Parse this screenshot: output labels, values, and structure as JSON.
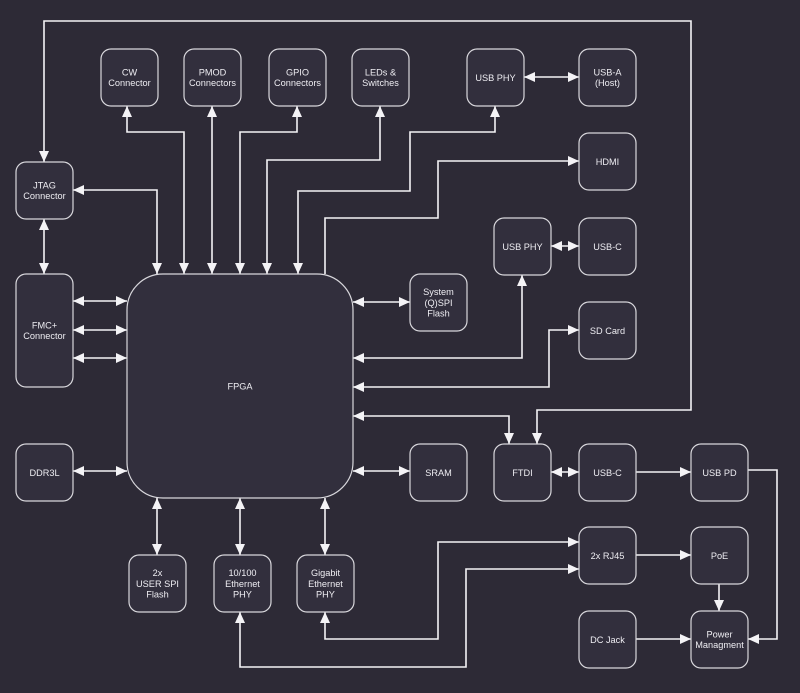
{
  "canvas": {
    "width": 800,
    "height": 693
  },
  "colors": {
    "background": "#2d2a36",
    "node_fill": "#322f3d",
    "node_border": "#d8d7dc",
    "edge": "#f4f3f6",
    "text": "#eeedf2"
  },
  "diagram": {
    "nodes": [
      {
        "id": "cw-connector",
        "label": [
          "CW",
          "Connector"
        ],
        "x": 101,
        "y": 49,
        "w": 57,
        "h": 57,
        "rx": 10
      },
      {
        "id": "pmod-connectors",
        "label": [
          "PMOD",
          "Connectors"
        ],
        "x": 184,
        "y": 49,
        "w": 57,
        "h": 57,
        "rx": 10
      },
      {
        "id": "gpio-connectors",
        "label": [
          "GPIO",
          "Connectors"
        ],
        "x": 269,
        "y": 49,
        "w": 57,
        "h": 57,
        "rx": 10
      },
      {
        "id": "leds-switches",
        "label": [
          "LEDs &",
          "Switches"
        ],
        "x": 352,
        "y": 49,
        "w": 57,
        "h": 57,
        "rx": 10
      },
      {
        "id": "usb-phy-top",
        "label": [
          "USB PHY"
        ],
        "x": 467,
        "y": 49,
        "w": 57,
        "h": 57,
        "rx": 10
      },
      {
        "id": "usb-a-host",
        "label": [
          "USB-A",
          "(Host)"
        ],
        "x": 579,
        "y": 49,
        "w": 57,
        "h": 57,
        "rx": 10
      },
      {
        "id": "jtag-connector",
        "label": [
          "JTAG",
          "Connector"
        ],
        "x": 16,
        "y": 162,
        "w": 57,
        "h": 57,
        "rx": 10
      },
      {
        "id": "hdmi",
        "label": [
          "HDMI"
        ],
        "x": 579,
        "y": 133,
        "w": 57,
        "h": 57,
        "rx": 10
      },
      {
        "id": "usb-phy-mid",
        "label": [
          "USB PHY"
        ],
        "x": 494,
        "y": 218,
        "w": 57,
        "h": 57,
        "rx": 10
      },
      {
        "id": "usb-c-top",
        "label": [
          "USB-C"
        ],
        "x": 579,
        "y": 218,
        "w": 57,
        "h": 57,
        "rx": 10
      },
      {
        "id": "fmc-connector",
        "label": [
          "FMC+",
          "Connector"
        ],
        "x": 16,
        "y": 274,
        "w": 57,
        "h": 113,
        "rx": 10
      },
      {
        "id": "system-qspi-flash",
        "label": [
          "System",
          "(Q)SPI",
          "Flash"
        ],
        "x": 410,
        "y": 274,
        "w": 57,
        "h": 57,
        "rx": 10
      },
      {
        "id": "sd-card",
        "label": [
          "SD Card"
        ],
        "x": 579,
        "y": 302,
        "w": 57,
        "h": 57,
        "rx": 10
      },
      {
        "id": "fpga",
        "label": [
          "FPGA"
        ],
        "x": 127,
        "y": 274,
        "w": 226,
        "h": 224,
        "rx": 36
      },
      {
        "id": "ddr3l",
        "label": [
          "DDR3L"
        ],
        "x": 16,
        "y": 444,
        "w": 57,
        "h": 57,
        "rx": 10
      },
      {
        "id": "sram",
        "label": [
          "SRAM"
        ],
        "x": 410,
        "y": 444,
        "w": 57,
        "h": 57,
        "rx": 10
      },
      {
        "id": "ftdi",
        "label": [
          "FTDI"
        ],
        "x": 494,
        "y": 444,
        "w": 57,
        "h": 57,
        "rx": 10
      },
      {
        "id": "usb-c-bottom",
        "label": [
          "USB-C"
        ],
        "x": 579,
        "y": 444,
        "w": 57,
        "h": 57,
        "rx": 10
      },
      {
        "id": "usb-pd",
        "label": [
          "USB PD"
        ],
        "x": 691,
        "y": 444,
        "w": 57,
        "h": 57,
        "rx": 10
      },
      {
        "id": "user-spi-flash",
        "label": [
          "2x",
          "USER SPI",
          "Flash"
        ],
        "x": 129,
        "y": 555,
        "w": 57,
        "h": 57,
        "rx": 10
      },
      {
        "id": "ethernet-phy-10-100",
        "label": [
          "10/100",
          "Ethernet",
          "PHY"
        ],
        "x": 214,
        "y": 555,
        "w": 57,
        "h": 57,
        "rx": 10
      },
      {
        "id": "ethernet-phy-gigabit",
        "label": [
          "Gigabit",
          "Ethernet",
          "PHY"
        ],
        "x": 297,
        "y": 555,
        "w": 57,
        "h": 57,
        "rx": 10
      },
      {
        "id": "rj45",
        "label": [
          "2x RJ45"
        ],
        "x": 579,
        "y": 527,
        "w": 57,
        "h": 57,
        "rx": 10
      },
      {
        "id": "poe",
        "label": [
          "PoE"
        ],
        "x": 691,
        "y": 527,
        "w": 57,
        "h": 57,
        "rx": 10
      },
      {
        "id": "dc-jack",
        "label": [
          "DC Jack"
        ],
        "x": 579,
        "y": 611,
        "w": 57,
        "h": 57,
        "rx": 10
      },
      {
        "id": "power-management",
        "label": [
          "Power",
          "Managment"
        ],
        "x": 691,
        "y": 611,
        "w": 57,
        "h": 57,
        "rx": 10
      }
    ],
    "edges": [
      {
        "from": "jtag-connector",
        "to": "ftdi",
        "arrows": "both",
        "points": [
          [
            44,
            162
          ],
          [
            44,
            21
          ],
          [
            691,
            21
          ],
          [
            691,
            410
          ],
          [
            537,
            410
          ],
          [
            537,
            444
          ]
        ]
      },
      {
        "from": "jtag-connector",
        "to": "fpga",
        "arrows": "both",
        "points": [
          [
            73,
            190
          ],
          [
            157,
            190
          ],
          [
            157,
            274
          ]
        ]
      },
      {
        "from": "cw-connector",
        "to": "fpga",
        "arrows": "both",
        "points": [
          [
            127,
            106
          ],
          [
            127,
            132
          ],
          [
            184,
            132
          ],
          [
            184,
            274
          ]
        ]
      },
      {
        "from": "pmod-connectors",
        "to": "fpga",
        "arrows": "both",
        "points": [
          [
            212,
            106
          ],
          [
            212,
            274
          ]
        ]
      },
      {
        "from": "gpio-connectors",
        "to": "fpga",
        "arrows": "both",
        "points": [
          [
            297,
            106
          ],
          [
            297,
            132
          ],
          [
            240,
            132
          ],
          [
            240,
            274
          ]
        ]
      },
      {
        "from": "leds-switches",
        "to": "fpga",
        "arrows": "both",
        "points": [
          [
            380,
            106
          ],
          [
            380,
            160
          ],
          [
            267,
            160
          ],
          [
            267,
            274
          ]
        ]
      },
      {
        "from": "usb-phy-top",
        "to": "fpga",
        "arrows": "both",
        "points": [
          [
            495,
            106
          ],
          [
            495,
            132
          ],
          [
            410,
            132
          ],
          [
            410,
            191
          ],
          [
            298,
            191
          ],
          [
            298,
            274
          ]
        ]
      },
      {
        "from": "usb-phy-top",
        "to": "usb-a-host",
        "arrows": "both",
        "points": [
          [
            524,
            77
          ],
          [
            579,
            77
          ]
        ]
      },
      {
        "from": "fpga",
        "to": "hdmi",
        "arrows": "end",
        "points": [
          [
            325,
            274
          ],
          [
            325,
            218
          ],
          [
            438,
            218
          ],
          [
            438,
            161
          ],
          [
            579,
            161
          ]
        ]
      },
      {
        "from": "usb-phy-mid",
        "to": "usb-c-top",
        "arrows": "both",
        "points": [
          [
            551,
            246
          ],
          [
            579,
            246
          ]
        ]
      },
      {
        "from": "fpga",
        "to": "system-qspi-flash",
        "arrows": "both",
        "points": [
          [
            353,
            302
          ],
          [
            410,
            302
          ]
        ]
      },
      {
        "from": "fpga",
        "to": "usb-phy-mid",
        "arrows": "both",
        "points": [
          [
            353,
            358
          ],
          [
            522,
            358
          ],
          [
            522,
            275
          ]
        ]
      },
      {
        "from": "fpga",
        "to": "sd-card",
        "arrows": "both",
        "points": [
          [
            353,
            387
          ],
          [
            549,
            387
          ],
          [
            549,
            330
          ],
          [
            579,
            330
          ]
        ]
      },
      {
        "from": "fpga",
        "to": "ftdi",
        "arrows": "both",
        "points": [
          [
            353,
            416
          ],
          [
            509,
            416
          ],
          [
            509,
            444
          ]
        ]
      },
      {
        "from": "jtag-connector",
        "to": "fmc-connector",
        "arrows": "both",
        "points": [
          [
            44,
            219
          ],
          [
            44,
            274
          ]
        ]
      },
      {
        "from": "fmc-connector",
        "to": "fpga",
        "arrows": "both",
        "points": [
          [
            73,
            301
          ],
          [
            127,
            301
          ]
        ]
      },
      {
        "from": "fmc-connector",
        "to": "fpga",
        "arrows": "both",
        "points": [
          [
            73,
            330
          ],
          [
            127,
            330
          ]
        ]
      },
      {
        "from": "fmc-connector",
        "to": "fpga",
        "arrows": "both",
        "points": [
          [
            73,
            358
          ],
          [
            127,
            358
          ]
        ]
      },
      {
        "from": "ddr3l",
        "to": "fpga",
        "arrows": "both",
        "points": [
          [
            73,
            471
          ],
          [
            127,
            471
          ]
        ]
      },
      {
        "from": "fpga",
        "to": "sram",
        "arrows": "both",
        "points": [
          [
            353,
            471
          ],
          [
            410,
            471
          ]
        ]
      },
      {
        "from": "ftdi",
        "to": "usb-c-bottom",
        "arrows": "both",
        "points": [
          [
            551,
            472
          ],
          [
            579,
            472
          ]
        ]
      },
      {
        "from": "usb-c-bottom",
        "to": "usb-pd",
        "arrows": "end",
        "points": [
          [
            636,
            472
          ],
          [
            691,
            472
          ]
        ]
      },
      {
        "from": "usb-pd",
        "to": "power-management",
        "arrows": "end",
        "points": [
          [
            748,
            470
          ],
          [
            777,
            470
          ],
          [
            777,
            639
          ],
          [
            748,
            639
          ]
        ]
      },
      {
        "from": "rj45",
        "to": "poe",
        "arrows": "end",
        "points": [
          [
            636,
            555
          ],
          [
            691,
            555
          ]
        ]
      },
      {
        "from": "poe",
        "to": "power-management",
        "arrows": "end",
        "points": [
          [
            719,
            584
          ],
          [
            719,
            611
          ]
        ]
      },
      {
        "from": "dc-jack",
        "to": "power-management",
        "arrows": "end",
        "points": [
          [
            636,
            639
          ],
          [
            691,
            639
          ]
        ]
      },
      {
        "from": "fpga",
        "to": "user-spi-flash",
        "arrows": "both",
        "points": [
          [
            157,
            498
          ],
          [
            157,
            555
          ]
        ]
      },
      {
        "from": "fpga",
        "to": "ethernet-phy-10-100",
        "arrows": "both",
        "points": [
          [
            240,
            498
          ],
          [
            240,
            555
          ]
        ]
      },
      {
        "from": "fpga",
        "to": "ethernet-phy-gigabit",
        "arrows": "both",
        "points": [
          [
            325,
            498
          ],
          [
            325,
            555
          ]
        ]
      },
      {
        "from": "ethernet-phy-gigabit",
        "to": "rj45",
        "arrows": "both",
        "points": [
          [
            325,
            612
          ],
          [
            325,
            639
          ],
          [
            438,
            639
          ],
          [
            438,
            542
          ],
          [
            579,
            542
          ]
        ]
      },
      {
        "from": "ethernet-phy-10-100",
        "to": "rj45",
        "arrows": "both",
        "points": [
          [
            240,
            612
          ],
          [
            240,
            667
          ],
          [
            466,
            667
          ],
          [
            466,
            569
          ],
          [
            579,
            569
          ]
        ]
      }
    ]
  }
}
